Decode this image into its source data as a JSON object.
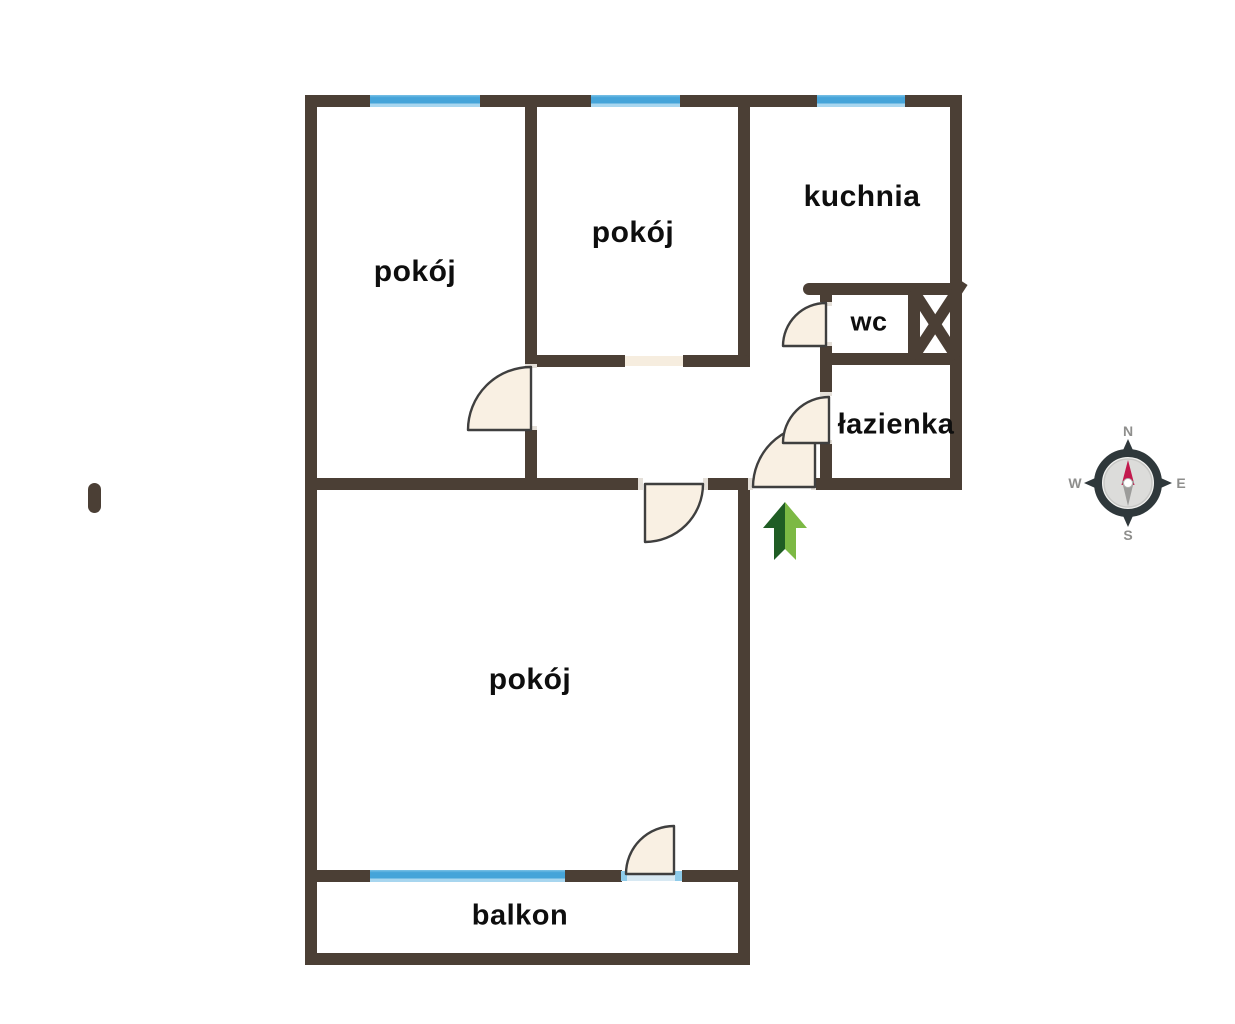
{
  "floorplan": {
    "rooms": [
      {
        "id": "room-top-left",
        "label": "pokój"
      },
      {
        "id": "room-top-middle",
        "label": "pokój"
      },
      {
        "id": "kitchen",
        "label": "kuchnia"
      },
      {
        "id": "wc",
        "label": "wc"
      },
      {
        "id": "bathroom",
        "label": "łazienka"
      },
      {
        "id": "room-large",
        "label": "pokój"
      },
      {
        "id": "balcony",
        "label": "balkon"
      }
    ],
    "compass": {
      "north": "N",
      "east": "E",
      "south": "S",
      "west": "W"
    },
    "icons": {
      "compass": "compass-rose",
      "entrance": "green-up-arrow",
      "shaft": "x-cross-shaft",
      "windows": "blue-window-strips",
      "doors": "quarter-circle-door-swings",
      "floor_marker": "brown-pill"
    },
    "colors": {
      "wall": "#4b3f35",
      "window": "#45a4d9",
      "window_light": "#a8d6ef",
      "door_fill": "#f9f0e3",
      "door_stroke": "#3f3f3f",
      "opening_fill": "#f6eddf",
      "threshold": "#d8e9f3",
      "threshold_jamb": "#8ecbea",
      "arrow_dark": "#1f5d24",
      "arrow_light": "#7cb944",
      "compass_ring": "#2f383b",
      "compass_face": "#dcdcda",
      "needle_north": "#c2194d",
      "needle_south": "#9c9c9a",
      "compass_text": "#8e8e8c",
      "label_text": "#0e0e0e"
    }
  }
}
